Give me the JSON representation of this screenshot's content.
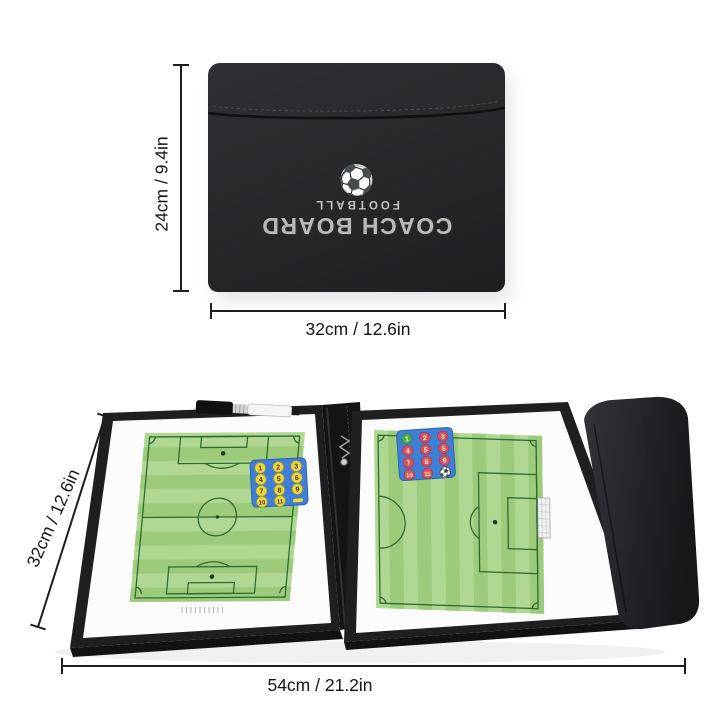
{
  "closed_case": {
    "brand_title": "COACH BOARD",
    "brand_subtitle": "FOOTBALL",
    "ball_icon": "⚽",
    "height_label": "24cm / 9.4in",
    "width_label": "32cm / 12.6in"
  },
  "open_board": {
    "height_label": "32cm / 12.6in",
    "width_label": "54cm / 21.2in",
    "left_pad": {
      "numbers": [
        "1",
        "2",
        "3",
        "4",
        "5",
        "6",
        "7",
        "8",
        "9",
        "10",
        "11"
      ],
      "extra_shape": "dash-magnet"
    },
    "right_pad": {
      "numbers": [
        "1",
        "2",
        "3",
        "4",
        "5",
        "6",
        "7",
        "8",
        "9",
        "10",
        "11"
      ],
      "extra": "⚽"
    }
  },
  "colors": {
    "case_black": "#29292c",
    "brand_silver": "#b9b9b9",
    "pitch_green_light": "#b0d893",
    "pitch_green_dark": "#9dcb7c",
    "pitch_line": "#2f6b30",
    "pad_blue": "#3f7fd6",
    "magnet_yellow": "#f4d62c",
    "magnet_red": "#d8505b",
    "magnet_green": "#3fae4d",
    "dimension_line": "#1d1d1f"
  }
}
